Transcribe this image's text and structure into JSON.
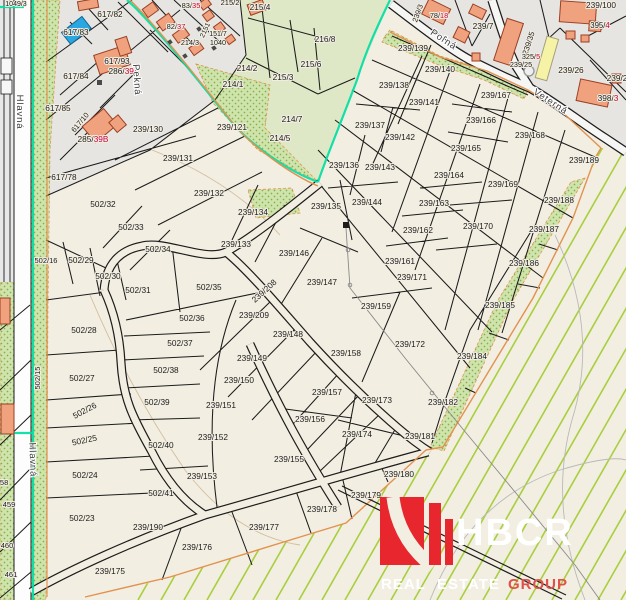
{
  "colors": {
    "cream": "#f2eee2",
    "gray_urban": "#e6e5e2",
    "olive_field": "#dfe8c6",
    "dotted_green": "#cfe4ad",
    "dot_color": "#86b04a",
    "hatch_green": "#a8cf3e",
    "boundary_teal": "#00dfa4",
    "boundary_orange": "#e2924f",
    "building_orange": "#efa27d",
    "building_blue": "#2aa7e0",
    "building_yellow": "#f6f2a6",
    "house_red": "#c8003c",
    "line_black": "#1c1c1c",
    "logo_red": "#e8262d",
    "logo_group_red": "#e0514d"
  },
  "logo": {
    "brand": "HBCR",
    "word1": "REAL",
    "word2": "ESTATE",
    "word3": "GROUP"
  },
  "labels": [
    {
      "t": "1049/3",
      "x": 16,
      "y": 6,
      "s": 7
    },
    {
      "t": "617/82",
      "x": 110,
      "y": 17
    },
    {
      "t": "617/83",
      "x": 76,
      "y": 35
    },
    {
      "t": "617/93",
      "x": 117,
      "y": 64
    },
    {
      "t": "286/",
      "t2": "39A",
      "x": 124,
      "y": 74
    },
    {
      "t": "617/84",
      "x": 76,
      "y": 79
    },
    {
      "t": "617/85",
      "x": 58,
      "y": 111
    },
    {
      "t": "617/10",
      "x": 82,
      "y": 124,
      "r": -50,
      "s": 7.5
    },
    {
      "t": "285/",
      "t2": "39B",
      "x": 93,
      "y": 142
    },
    {
      "t": "617/78",
      "x": 64,
      "y": 180
    },
    {
      "t": "82/",
      "t2": "37",
      "x": 176,
      "y": 29,
      "s": 7.5
    },
    {
      "t": "83/",
      "t2": "35",
      "x": 191,
      "y": 8,
      "s": 7.5
    },
    {
      "t": "2151",
      "x": 207,
      "y": 31,
      "r": -65,
      "s": 7
    },
    {
      "t": "151/7",
      "x": 218,
      "y": 36,
      "s": 7
    },
    {
      "t": "1040",
      "x": 218,
      "y": 45,
      "s": 7.3
    },
    {
      "t": "214/3",
      "x": 190,
      "y": 45,
      "s": 7.3
    },
    {
      "t": "215/2",
      "x": 230,
      "y": 5,
      "s": 7.5
    },
    {
      "t": "Pekná",
      "x": 134,
      "y": 80,
      "r": 86,
      "k": "street"
    },
    {
      "t": "215/4",
      "x": 260,
      "y": 10
    },
    {
      "t": "214/2",
      "x": 247,
      "y": 71
    },
    {
      "t": "214/1",
      "x": 233,
      "y": 87
    },
    {
      "t": "215/3",
      "x": 283,
      "y": 80
    },
    {
      "t": "214/7",
      "x": 292,
      "y": 122
    },
    {
      "t": "214/5",
      "x": 280,
      "y": 141
    },
    {
      "t": "216/8",
      "x": 325,
      "y": 42
    },
    {
      "t": "215/6",
      "x": 311,
      "y": 67
    },
    {
      "t": "239/121",
      "x": 232,
      "y": 130
    },
    {
      "t": "239/3",
      "x": 420,
      "y": 14,
      "r": -70,
      "s": 7.3
    },
    {
      "t": "78/",
      "t2": "18",
      "x": 439,
      "y": 18,
      "s": 7.3
    },
    {
      "t": "239/7",
      "x": 483,
      "y": 29
    },
    {
      "t": "239/100",
      "x": 601,
      "y": 8
    },
    {
      "t": "395/",
      "t2": "4",
      "x": 600,
      "y": 28,
      "s": 7.8
    },
    {
      "t": "239/35",
      "x": 531,
      "y": 44,
      "r": -72,
      "s": 7.8
    },
    {
      "t": "325/",
      "t2": "5",
      "x": 531,
      "y": 59,
      "s": 7.3
    },
    {
      "t": "239/25",
      "x": 521,
      "y": 67,
      "s": 7.3
    },
    {
      "t": "239/26",
      "x": 571,
      "y": 73
    },
    {
      "t": "239/2",
      "x": 617,
      "y": 81
    },
    {
      "t": "398/",
      "t2": "3",
      "x": 608,
      "y": 101
    },
    {
      "t": "Poľná",
      "x": 442,
      "y": 42,
      "r": 33,
      "k": "street"
    },
    {
      "t": "Veterná",
      "x": 549,
      "y": 104,
      "r": 33,
      "k": "street"
    },
    {
      "t": "239/130",
      "x": 148,
      "y": 132
    },
    {
      "t": "239/131",
      "x": 178,
      "y": 161
    },
    {
      "t": "239/132",
      "x": 209,
      "y": 196
    },
    {
      "t": "239/134",
      "x": 253,
      "y": 215
    },
    {
      "t": "239/133",
      "x": 236,
      "y": 247
    },
    {
      "t": "239/146",
      "x": 294,
      "y": 256
    },
    {
      "t": "239/147",
      "x": 322,
      "y": 285
    },
    {
      "t": "239/135",
      "x": 326,
      "y": 209
    },
    {
      "t": "239/139",
      "x": 413,
      "y": 51
    },
    {
      "t": "239/140",
      "x": 440,
      "y": 72
    },
    {
      "t": "239/138",
      "x": 394,
      "y": 88
    },
    {
      "t": "239/141",
      "x": 424,
      "y": 105
    },
    {
      "t": "239/137",
      "x": 370,
      "y": 128
    },
    {
      "t": "239/142",
      "x": 400,
      "y": 140
    },
    {
      "t": "239/136",
      "x": 344,
      "y": 168
    },
    {
      "t": "239/143",
      "x": 380,
      "y": 170
    },
    {
      "t": "239/144",
      "x": 367,
      "y": 205
    },
    {
      "t": "239/164",
      "x": 449,
      "y": 178
    },
    {
      "t": "239/163",
      "x": 434,
      "y": 206
    },
    {
      "t": "239/162",
      "x": 418,
      "y": 233
    },
    {
      "t": "239/161",
      "x": 400,
      "y": 264
    },
    {
      "t": "239/171",
      "x": 412,
      "y": 280
    },
    {
      "t": "239/169",
      "x": 503,
      "y": 187
    },
    {
      "t": "239/170",
      "x": 478,
      "y": 229
    },
    {
      "t": "239/167",
      "x": 496,
      "y": 98
    },
    {
      "t": "239/166",
      "x": 481,
      "y": 123
    },
    {
      "t": "239/165",
      "x": 466,
      "y": 151
    },
    {
      "t": "239/168",
      "x": 530,
      "y": 138
    },
    {
      "t": "239/189",
      "x": 584,
      "y": 163
    },
    {
      "t": "239/188",
      "x": 559,
      "y": 203
    },
    {
      "t": "239/187",
      "x": 544,
      "y": 232
    },
    {
      "t": "239/186",
      "x": 524,
      "y": 266
    },
    {
      "t": "239/185",
      "x": 500,
      "y": 308
    },
    {
      "t": "239/184",
      "x": 472,
      "y": 359
    },
    {
      "t": "239/172",
      "x": 410,
      "y": 347
    },
    {
      "t": "239/159",
      "x": 376,
      "y": 309
    },
    {
      "t": "239/158",
      "x": 346,
      "y": 356
    },
    {
      "t": "239/157",
      "x": 327,
      "y": 395
    },
    {
      "t": "239/173",
      "x": 377,
      "y": 403
    },
    {
      "t": "239/182",
      "x": 443,
      "y": 405
    },
    {
      "t": "239/156",
      "x": 310,
      "y": 422
    },
    {
      "t": "239/174",
      "x": 357,
      "y": 437
    },
    {
      "t": "239/181",
      "x": 420,
      "y": 439
    },
    {
      "t": "239/180",
      "x": 399,
      "y": 477
    },
    {
      "t": "239/179",
      "x": 366,
      "y": 498
    },
    {
      "t": "239/178",
      "x": 322,
      "y": 512
    },
    {
      "t": "239/155",
      "x": 289,
      "y": 462
    },
    {
      "t": "239/175",
      "x": 110,
      "y": 574
    },
    {
      "t": "239/176",
      "x": 197,
      "y": 550
    },
    {
      "t": "239/177",
      "x": 264,
      "y": 530
    },
    {
      "t": "239/190",
      "x": 148,
      "y": 530
    },
    {
      "t": "239/208",
      "x": 266,
      "y": 293,
      "r": -42
    },
    {
      "t": "239/209",
      "x": 254,
      "y": 318
    },
    {
      "t": "239/148",
      "x": 288,
      "y": 337
    },
    {
      "t": "239/149",
      "x": 252,
      "y": 361
    },
    {
      "t": "239/150",
      "x": 239,
      "y": 383
    },
    {
      "t": "239/151",
      "x": 221,
      "y": 408
    },
    {
      "t": "239/152",
      "x": 213,
      "y": 440
    },
    {
      "t": "239/153",
      "x": 202,
      "y": 479
    },
    {
      "t": "502/32",
      "x": 103,
      "y": 207
    },
    {
      "t": "502/33",
      "x": 131,
      "y": 230
    },
    {
      "t": "502/34",
      "x": 158,
      "y": 252
    },
    {
      "t": "502/16",
      "x": 46,
      "y": 263,
      "s": 7.5
    },
    {
      "t": "502/29",
      "x": 81,
      "y": 263
    },
    {
      "t": "502/30",
      "x": 108,
      "y": 279
    },
    {
      "t": "502/31",
      "x": 138,
      "y": 293
    },
    {
      "t": "502/35",
      "x": 209,
      "y": 290
    },
    {
      "t": "502/28",
      "x": 84,
      "y": 333
    },
    {
      "t": "502/36",
      "x": 192,
      "y": 321
    },
    {
      "t": "502/37",
      "x": 180,
      "y": 346
    },
    {
      "t": "502/27",
      "x": 82,
      "y": 381
    },
    {
      "t": "502/38",
      "x": 166,
      "y": 373
    },
    {
      "t": "502/39",
      "x": 157,
      "y": 405
    },
    {
      "t": "502/26",
      "x": 86,
      "y": 413,
      "r": -28
    },
    {
      "t": "502/25",
      "x": 85,
      "y": 443,
      "r": -12
    },
    {
      "t": "502/40",
      "x": 161,
      "y": 448
    },
    {
      "t": "502/24",
      "x": 85,
      "y": 478
    },
    {
      "t": "502/41",
      "x": 161,
      "y": 496
    },
    {
      "t": "502/23",
      "x": 82,
      "y": 521
    },
    {
      "t": "502/15",
      "x": 40,
      "y": 378,
      "r": -90,
      "s": 7.5
    },
    {
      "t": "Hlavná",
      "x": 17,
      "y": 112,
      "r": 90,
      "k": "street"
    },
    {
      "t": "Hlavná",
      "x": 30,
      "y": 460,
      "r": 88,
      "k": "street"
    },
    {
      "t": "458",
      "x": 2,
      "y": 485,
      "s": 7.5
    },
    {
      "t": "459",
      "x": 9,
      "y": 507,
      "s": 7.5
    },
    {
      "t": "460",
      "x": 7,
      "y": 548,
      "s": 7.5
    },
    {
      "t": "461",
      "x": 11,
      "y": 577,
      "s": 7.5
    }
  ]
}
